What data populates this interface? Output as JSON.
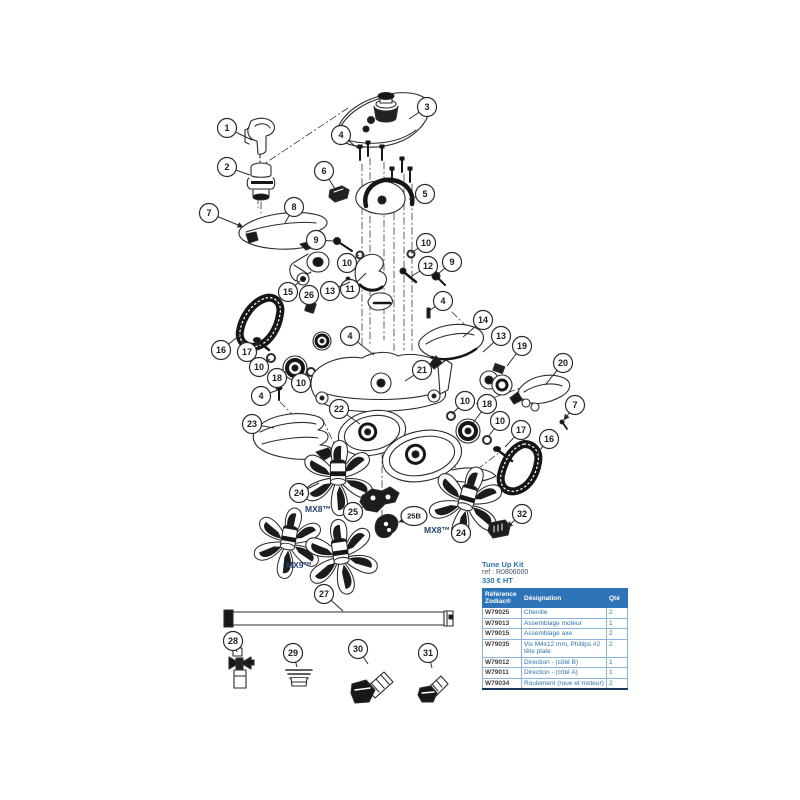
{
  "colors": {
    "accent_blue": "#2E74B5",
    "table_header_bg": "#2D74B8",
    "table_header_text": "#FFFFFF",
    "line_art": "#2B2B2B"
  },
  "diagram": {
    "labels": [
      {
        "text": "MX8™",
        "x": 318,
        "y": 512
      },
      {
        "text": "MX8™",
        "x": 437,
        "y": 533
      },
      {
        "text": "MX9™",
        "x": 299,
        "y": 568
      }
    ],
    "callouts": [
      {
        "n": "1",
        "x": 227,
        "y": 128,
        "tx": 252,
        "ty": 140
      },
      {
        "n": "2",
        "x": 227,
        "y": 167,
        "tx": 250,
        "ty": 175
      },
      {
        "n": "3",
        "x": 427,
        "y": 107,
        "tx": 409,
        "ty": 119
      },
      {
        "n": "4",
        "x": 341,
        "y": 135,
        "tx": 359,
        "ty": 149
      },
      {
        "n": "6",
        "x": 324,
        "y": 171,
        "tx": 335,
        "ty": 189
      },
      {
        "n": "5",
        "x": 425,
        "y": 194,
        "tx": 409,
        "ty": 199
      },
      {
        "n": "7",
        "x": 209,
        "y": 213,
        "tx": 243,
        "ty": 227,
        "arrow": true
      },
      {
        "n": "8",
        "x": 294,
        "y": 207,
        "tx": 285,
        "ty": 223
      },
      {
        "n": "9",
        "x": 316,
        "y": 240,
        "tx": 334,
        "ty": 241
      },
      {
        "n": "10",
        "x": 347,
        "y": 263,
        "tx": 359,
        "ty": 255
      },
      {
        "n": "10",
        "x": 426,
        "y": 243,
        "tx": 411,
        "ty": 253
      },
      {
        "n": "11",
        "x": 350,
        "y": 289,
        "tx": 366,
        "ty": 273
      },
      {
        "n": "12",
        "x": 428,
        "y": 266,
        "tx": 412,
        "ty": 276
      },
      {
        "n": "13",
        "x": 330,
        "y": 291,
        "tx": 350,
        "ty": 282
      },
      {
        "n": "9",
        "x": 452,
        "y": 262,
        "tx": 438,
        "ty": 274
      },
      {
        "n": "15",
        "x": 288,
        "y": 292,
        "tx": 300,
        "ty": 281
      },
      {
        "n": "26",
        "x": 309,
        "y": 295,
        "tx": 311,
        "ty": 306
      },
      {
        "n": "4",
        "x": 443,
        "y": 301,
        "tx": 429,
        "ty": 311
      },
      {
        "n": "14",
        "x": 483,
        "y": 320,
        "tx": 463,
        "ty": 337
      },
      {
        "n": "13",
        "x": 501,
        "y": 336,
        "tx": 483,
        "ty": 352
      },
      {
        "n": "19",
        "x": 522,
        "y": 346,
        "tx": 507,
        "ty": 366
      },
      {
        "n": "20",
        "x": 563,
        "y": 363,
        "tx": 546,
        "ty": 384
      },
      {
        "n": "16",
        "x": 221,
        "y": 350,
        "tx": 240,
        "ty": 335
      },
      {
        "n": "17",
        "x": 247,
        "y": 352,
        "tx": 259,
        "ty": 343
      },
      {
        "n": "10",
        "x": 259,
        "y": 367,
        "tx": 270,
        "ty": 359
      },
      {
        "n": "18",
        "x": 277,
        "y": 378,
        "tx": 288,
        "ty": 370
      },
      {
        "n": "10",
        "x": 301,
        "y": 383,
        "tx": 309,
        "ty": 374
      },
      {
        "n": "4",
        "x": 350,
        "y": 336,
        "tx": 374,
        "ty": 355
      },
      {
        "n": "21",
        "x": 422,
        "y": 370,
        "tx": 405,
        "ty": 381
      },
      {
        "n": "4",
        "x": 261,
        "y": 396,
        "tx": 278,
        "ty": 390
      },
      {
        "n": "10",
        "x": 465,
        "y": 401,
        "tx": 452,
        "ty": 414
      },
      {
        "n": "18",
        "x": 487,
        "y": 404,
        "tx": 473,
        "ty": 423
      },
      {
        "n": "7",
        "x": 575,
        "y": 405,
        "tx": 564,
        "ty": 420,
        "arrow": true
      },
      {
        "n": "22",
        "x": 339,
        "y": 409,
        "tx": 360,
        "ty": 424
      },
      {
        "n": "10",
        "x": 500,
        "y": 421,
        "tx": 488,
        "ty": 437
      },
      {
        "n": "23",
        "x": 252,
        "y": 424,
        "tx": 274,
        "ty": 428
      },
      {
        "n": "17",
        "x": 521,
        "y": 430,
        "tx": 505,
        "ty": 447
      },
      {
        "n": "16",
        "x": 549,
        "y": 439,
        "tx": 536,
        "ty": 455
      },
      {
        "n": "24",
        "x": 299,
        "y": 493,
        "tx": 319,
        "ty": 483
      },
      {
        "n": "25",
        "x": 353,
        "y": 512,
        "tx": 367,
        "ty": 505
      },
      {
        "n": "25B",
        "x": 414,
        "y": 516,
        "tx": 399,
        "ty": 522,
        "arrow": true,
        "wide": true
      },
      {
        "n": "32",
        "x": 522,
        "y": 514,
        "tx": 507,
        "ty": 527,
        "arrow": true
      },
      {
        "n": "24",
        "x": 461,
        "y": 533,
        "tx": 466,
        "ty": 520
      },
      {
        "n": "27",
        "x": 324,
        "y": 594,
        "tx": 343,
        "ty": 611
      },
      {
        "n": "28",
        "x": 233,
        "y": 641,
        "tx": 237,
        "ty": 652
      },
      {
        "n": "29",
        "x": 293,
        "y": 653,
        "tx": 297,
        "ty": 667
      },
      {
        "n": "30",
        "x": 358,
        "y": 649,
        "tx": 368,
        "ty": 664
      },
      {
        "n": "31",
        "x": 428,
        "y": 653,
        "tx": 432,
        "ty": 668
      }
    ]
  },
  "kit": {
    "title": "Tune Up Kit",
    "ref_line": "ref :  R0806000",
    "price": "330 € HT"
  },
  "table": {
    "headers": [
      "Référence Zodiac®",
      "Désignation",
      "Qté"
    ],
    "rows": [
      {
        "ref": "W79025",
        "designation": "Chenille",
        "qty": "2"
      },
      {
        "ref": "W79013",
        "designation": "Assemblage moteur",
        "qty": "1"
      },
      {
        "ref": "W79015",
        "designation": "Assemblage axe",
        "qty": "2"
      },
      {
        "ref": "W79035",
        "designation": "Vis M4x12 mm, Phillips #2 tête plate",
        "qty": "2"
      },
      {
        "ref": "W79012",
        "designation": "Direction - (côté B)",
        "qty": "1"
      },
      {
        "ref": "W79011",
        "designation": "Direction - (côté A)",
        "qty": "1"
      },
      {
        "ref": "W79034",
        "designation": "Roulement (roue et moteur)",
        "qty": "2"
      }
    ]
  }
}
